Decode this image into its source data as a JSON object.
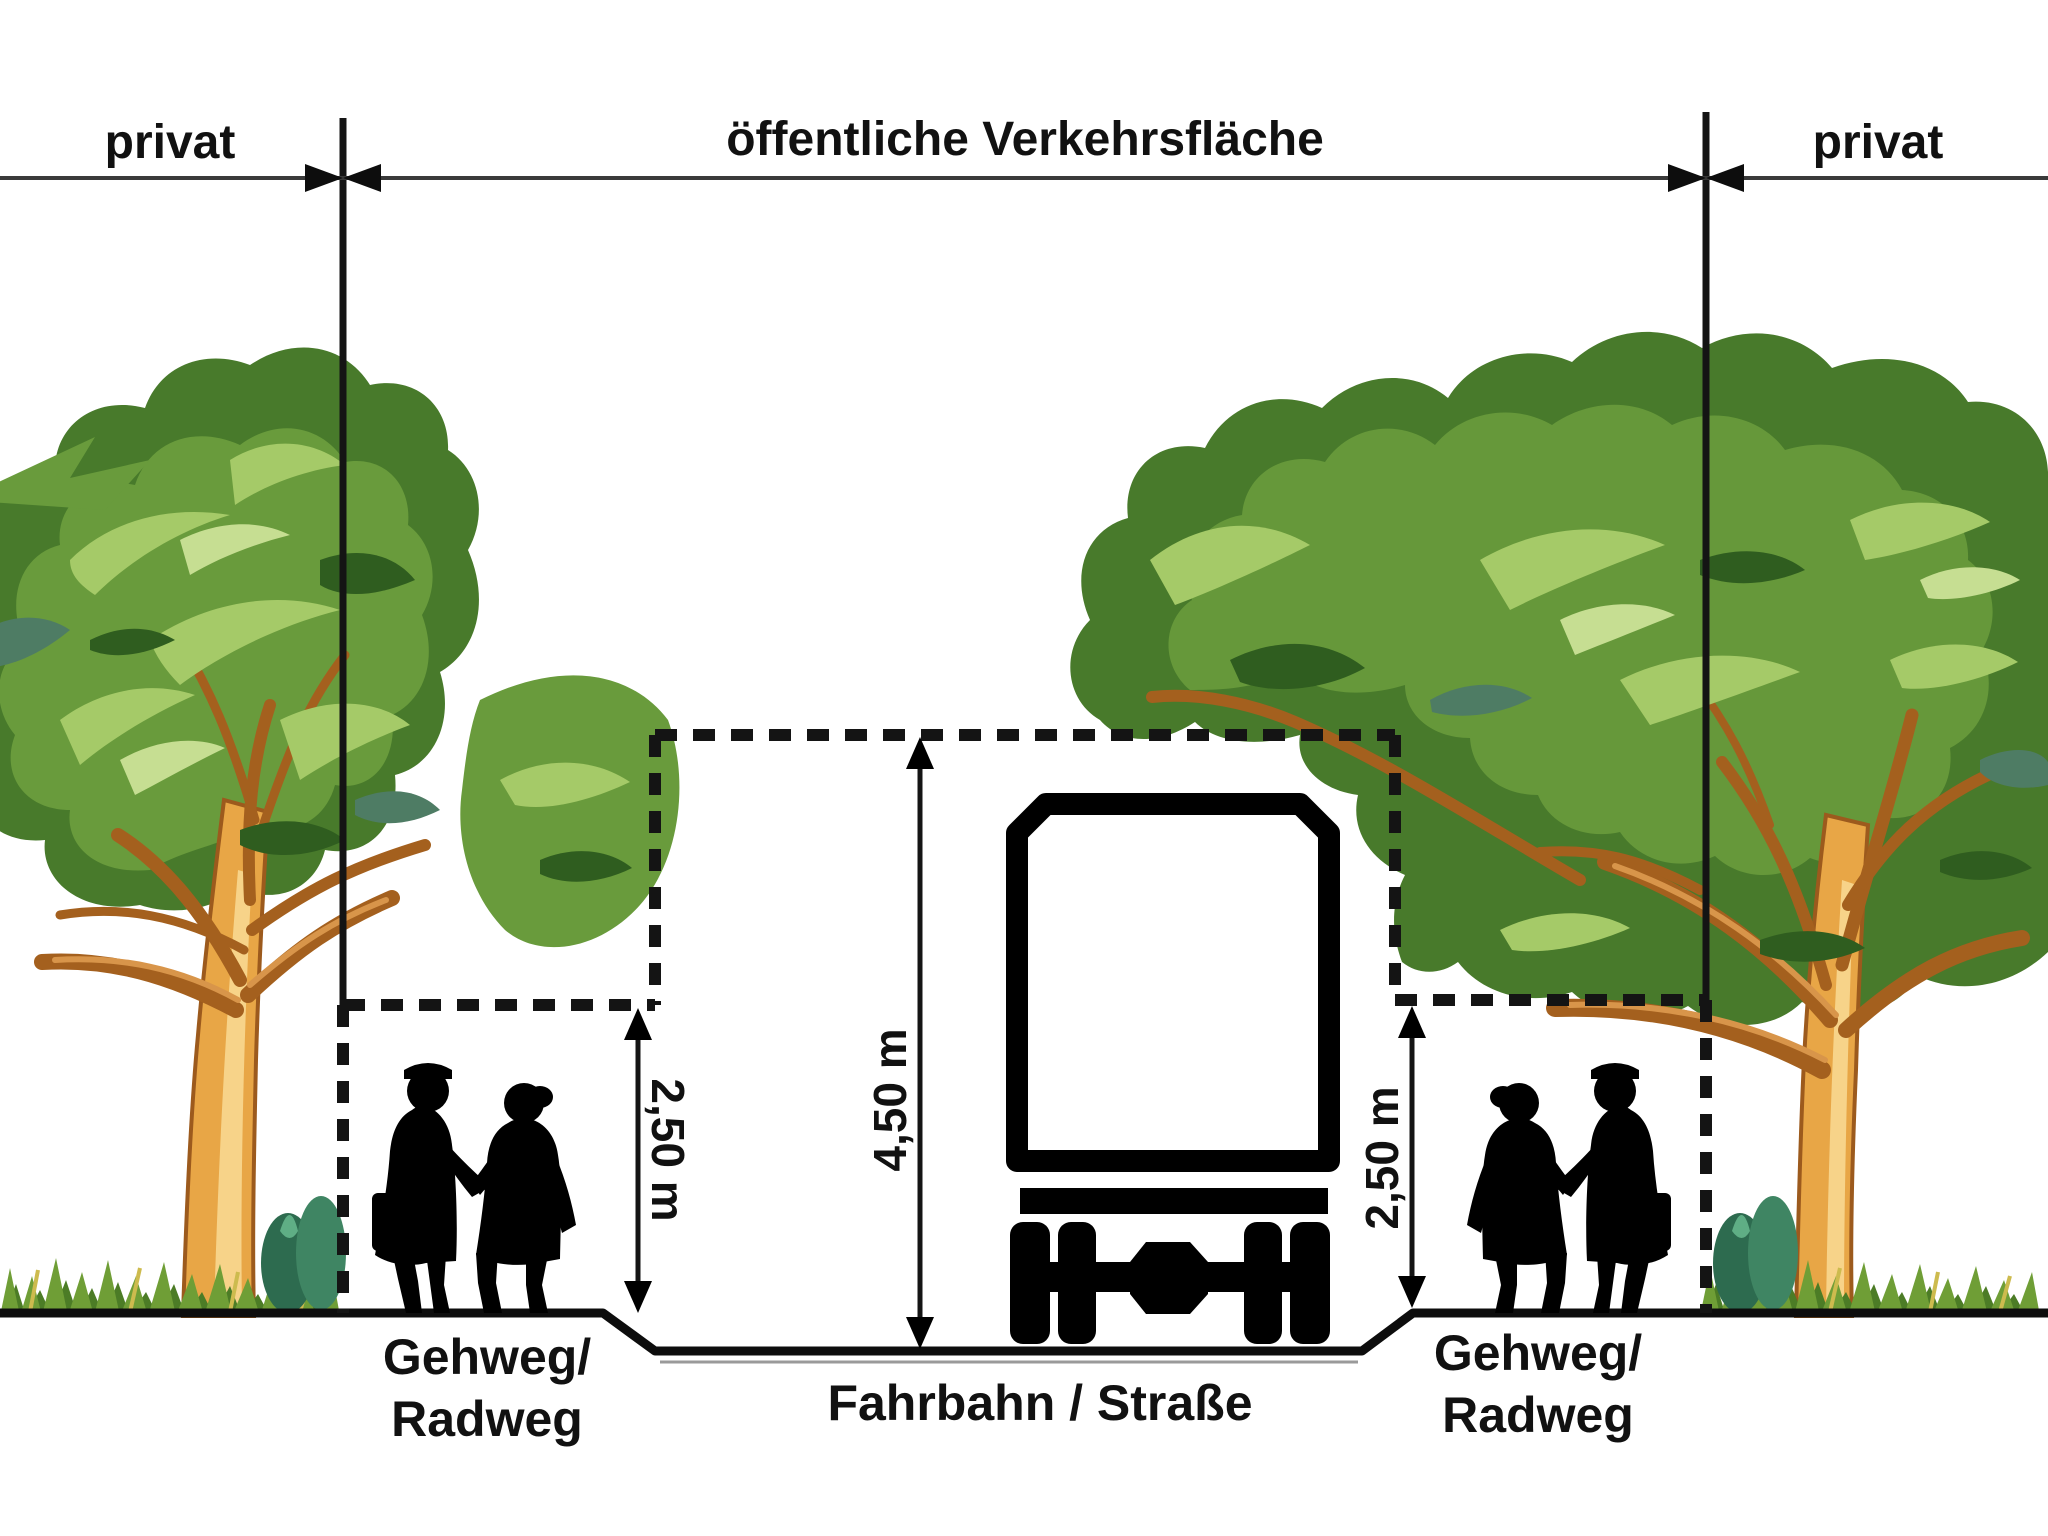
{
  "labels": {
    "private_left": "privat",
    "public_area": "öffentliche Verkehrsfläche",
    "private_right": "privat",
    "clearance_road": "4,50 m",
    "clearance_path_left": "2,50 m",
    "clearance_path_right": "2,50 m",
    "footpath_left_line1": "Gehweg/",
    "footpath_left_line2": "Radweg",
    "roadway": "Fahrbahn / Straße",
    "footpath_right_line1": "Gehweg/",
    "footpath_right_line2": "Radweg"
  },
  "colors": {
    "background": "#ffffff",
    "line": "#141414",
    "dimension_line": "#3a3a3a",
    "foliage_dark": "#487a2b",
    "foliage_mid": "#699b3c",
    "foliage_light": "#a5ca68",
    "foliage_pale": "#c6de92",
    "foliage_shadow": "#4e7c64",
    "trunk": "#e8a646",
    "trunk_highlight": "#f7d389",
    "branch": "#a4601e",
    "grass": "#6f9e36",
    "silhouette": "#000000"
  }
}
